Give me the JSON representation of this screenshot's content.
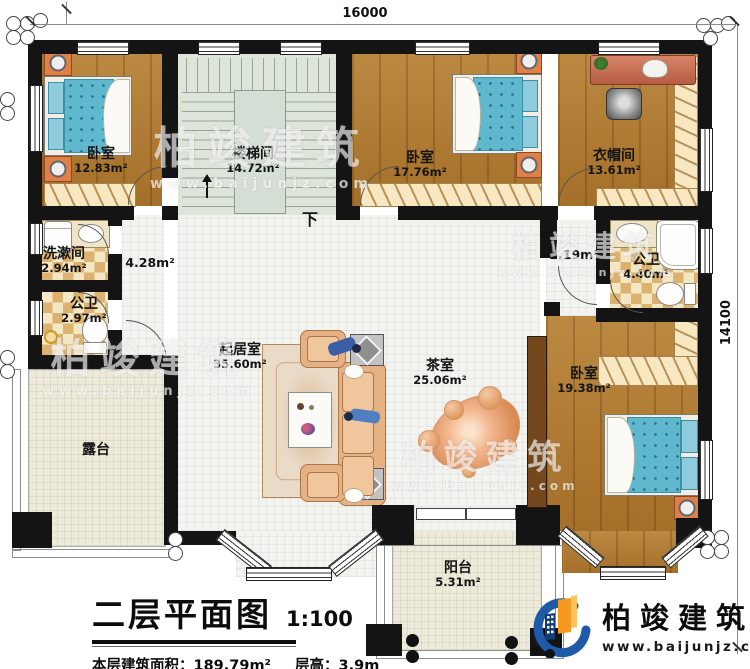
{
  "plan": {
    "dimensions": {
      "width_top": "16000",
      "height_right": "14100"
    },
    "stair": {
      "down_label": "下"
    },
    "rooms": {
      "bedroom1": {
        "name": "卧室",
        "area": "12.83m²"
      },
      "stairwell": {
        "name": "楼梯间",
        "area": "14.72m²"
      },
      "bedroom2": {
        "name": "卧室",
        "area": "17.76m²"
      },
      "cloakroom": {
        "name": "衣帽间",
        "area": "13.61m²"
      },
      "washroom": {
        "name": "洗漱间",
        "area": "2.94m²"
      },
      "bath_left": {
        "name": "公卫",
        "area": "2.97m²"
      },
      "hall_left": {
        "area": "4.28m²"
      },
      "hall_right": {
        "area": "2.19m²"
      },
      "bath_right": {
        "name": "公卫",
        "area": "4.40m²"
      },
      "living": {
        "name": "起居室",
        "area": "35.60m²"
      },
      "tea": {
        "name": "茶室",
        "area": "25.06m²"
      },
      "bedroom3": {
        "name": "卧室",
        "area": "19.38m²"
      },
      "terrace": {
        "name": "露台"
      },
      "balcony": {
        "name": "阳台",
        "area": "5.31m²"
      }
    }
  },
  "title_block": {
    "title": "二层平面图",
    "scale": "1:100",
    "area_info": "本层建筑面积：189.79m²",
    "height_info": "层高：3.9m"
  },
  "brand": {
    "name": "柏竣建筑",
    "url": "www.baijunjz.com"
  },
  "watermark": {
    "name": "柏竣建筑",
    "url": "www.baijunjz.com"
  },
  "colors": {
    "wall": "#141414",
    "wood_floor": "#b0792f",
    "tile_floor": "#f3f3ef",
    "stair_floor": "#dde4da",
    "checker_dark": "#dcb271",
    "checker_light": "#f4e7c4",
    "outdoor_floor": "#edeada",
    "bed_blue": "#5fb8ce",
    "nightstand_orange": "#e08048",
    "brand_blue": "#1e5aa8",
    "brand_orange": "#f59a1e"
  }
}
